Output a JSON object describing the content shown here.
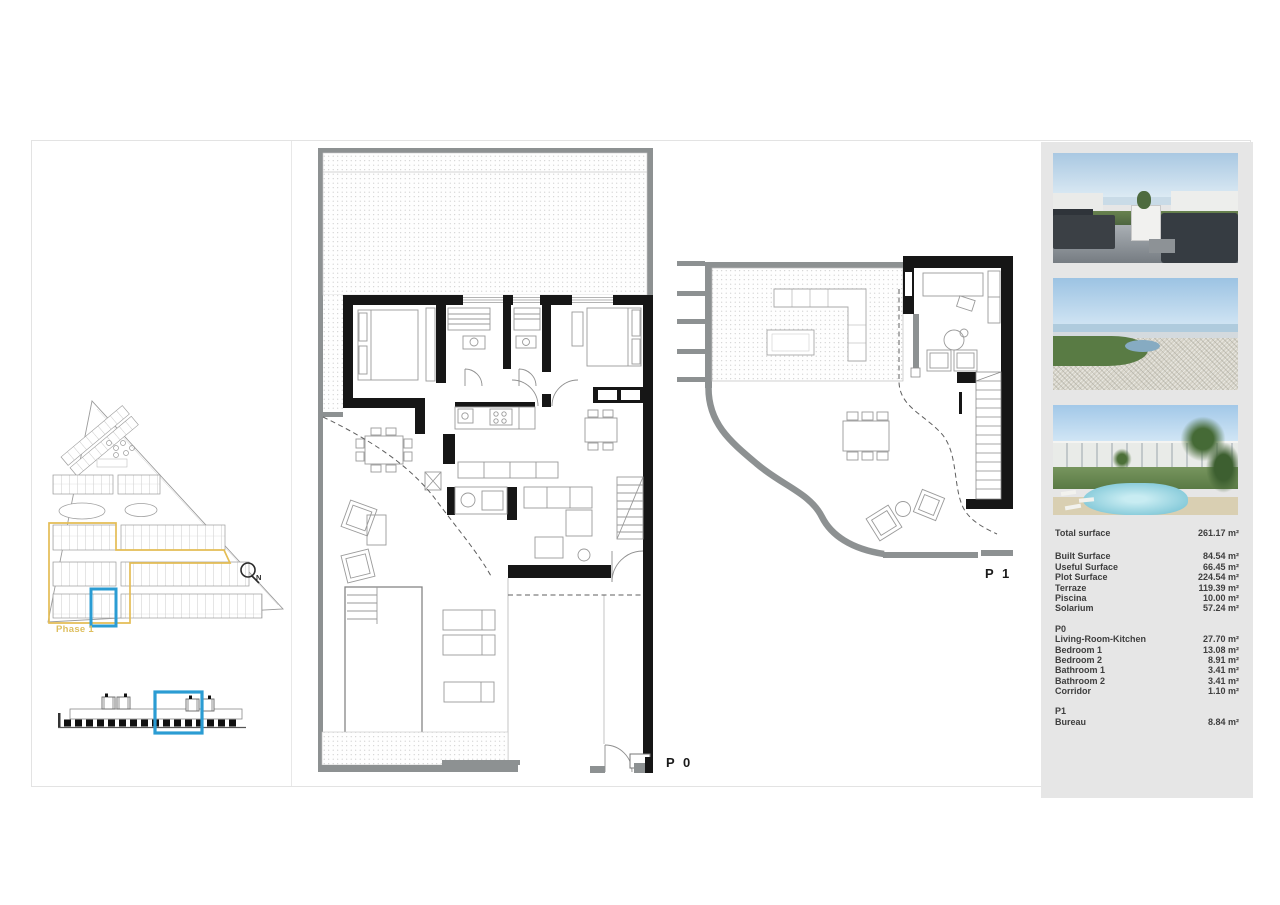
{
  "labels": {
    "floor0": "P 0",
    "floor1": "P 1",
    "phase": "Phase 1",
    "compass_north": "N"
  },
  "colors": {
    "highlight_blue": "#2b9cd3",
    "highlight_yellow": "#e4bd55",
    "panel_background": "#e6e6e6",
    "wall_black": "#161616",
    "wall_gray": "#8d9192"
  },
  "surface_table": {
    "total": {
      "label": "Total surface",
      "value": "261.17 m²"
    },
    "general_rows": [
      {
        "label": "Built Surface",
        "value": "84.54 m²"
      },
      {
        "label": "Useful Surface",
        "value": "66.45 m²"
      },
      {
        "label": "Plot Surface",
        "value": "224.54 m²"
      },
      {
        "label": "Terraze",
        "value": "119.39 m²"
      },
      {
        "label": "Piscina",
        "value": "10.00 m²"
      },
      {
        "label": "Solarium",
        "value": "57.24 m²"
      }
    ],
    "p0_section": {
      "title": "P0",
      "rows": [
        {
          "label": "Living-Room-Kitchen",
          "value": "27.70 m²"
        },
        {
          "label": "Bedroom 1",
          "value": "13.08 m²"
        },
        {
          "label": "Bedroom 2",
          "value": "8.91 m²"
        },
        {
          "label": "Bathroom 1",
          "value": "3.41 m²"
        },
        {
          "label": "Bathroom 2",
          "value": "3.41 m²"
        },
        {
          "label": "Corridor",
          "value": "1.10 m²"
        }
      ]
    },
    "p1_section": {
      "title": "P1",
      "rows": [
        {
          "label": "Bureau",
          "value": "8.84 m²"
        }
      ]
    }
  }
}
